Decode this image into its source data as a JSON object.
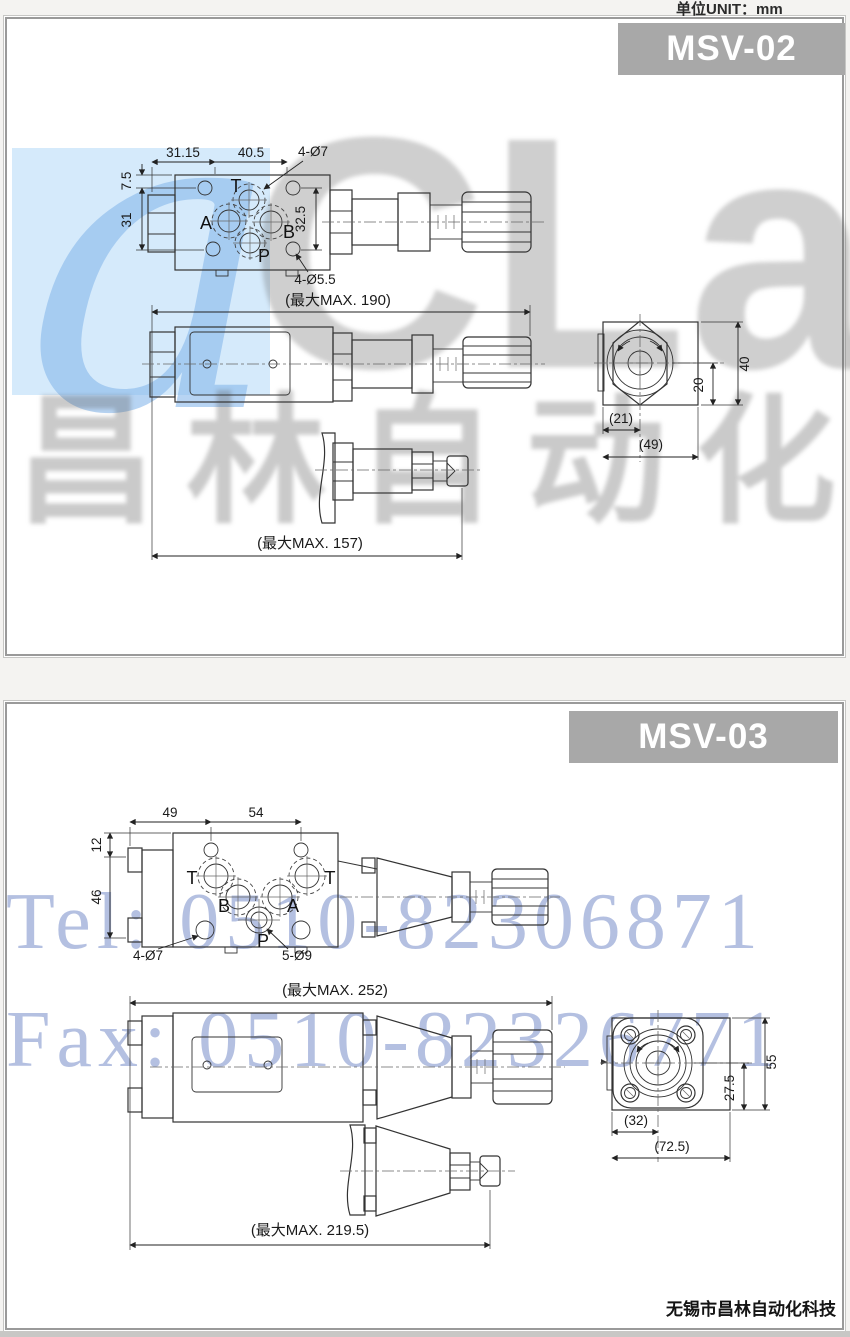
{
  "page": {
    "unit_label": "单位UNIT：mm",
    "footer": "无锡市昌林自动化科技"
  },
  "watermark": {
    "letter": "a",
    "brand": "CLair",
    "cn": "昌林自动化",
    "tel": "Tel: 0510-82306871",
    "fax": "Fax: 0510-82326771",
    "blue_block_color": "#d5eafb",
    "tel_color": "#7e92cc",
    "header_bg": "#a8a8a8"
  },
  "panels": {
    "msv02": {
      "title": "MSV-02",
      "tv": {
        "w1": "31.15",
        "w2": "40.5",
        "ht": "4-Ø7",
        "h1": "7.5",
        "h2": "31",
        "v1": "32.5",
        "hb": "4-Ø5.5",
        "t": "T",
        "a": "A",
        "b": "B",
        "p": "P"
      },
      "sv": {
        "max": "(最大MAX. 190)"
      },
      "vv": {
        "max": "(最大MAX. 157)"
      },
      "ev": {
        "w1": "(21)",
        "w2": "(49)",
        "h1": "20",
        "h2": "40"
      }
    },
    "msv03": {
      "title": "MSV-03",
      "tv": {
        "w1": "49",
        "w2": "54",
        "h1": "12",
        "h2": "46",
        "hl": "4-Ø7",
        "hb": "5-Ø9",
        "t1": "T",
        "b": "B",
        "a": "A",
        "t2": "T",
        "p": "P"
      },
      "sv": {
        "max": "(最大MAX. 252)"
      },
      "vv": {
        "max": "(最大MAX. 219.5)"
      },
      "ev": {
        "w1": "(32)",
        "w2": "(72.5)",
        "h1": "27.5",
        "h2": "55"
      }
    }
  }
}
